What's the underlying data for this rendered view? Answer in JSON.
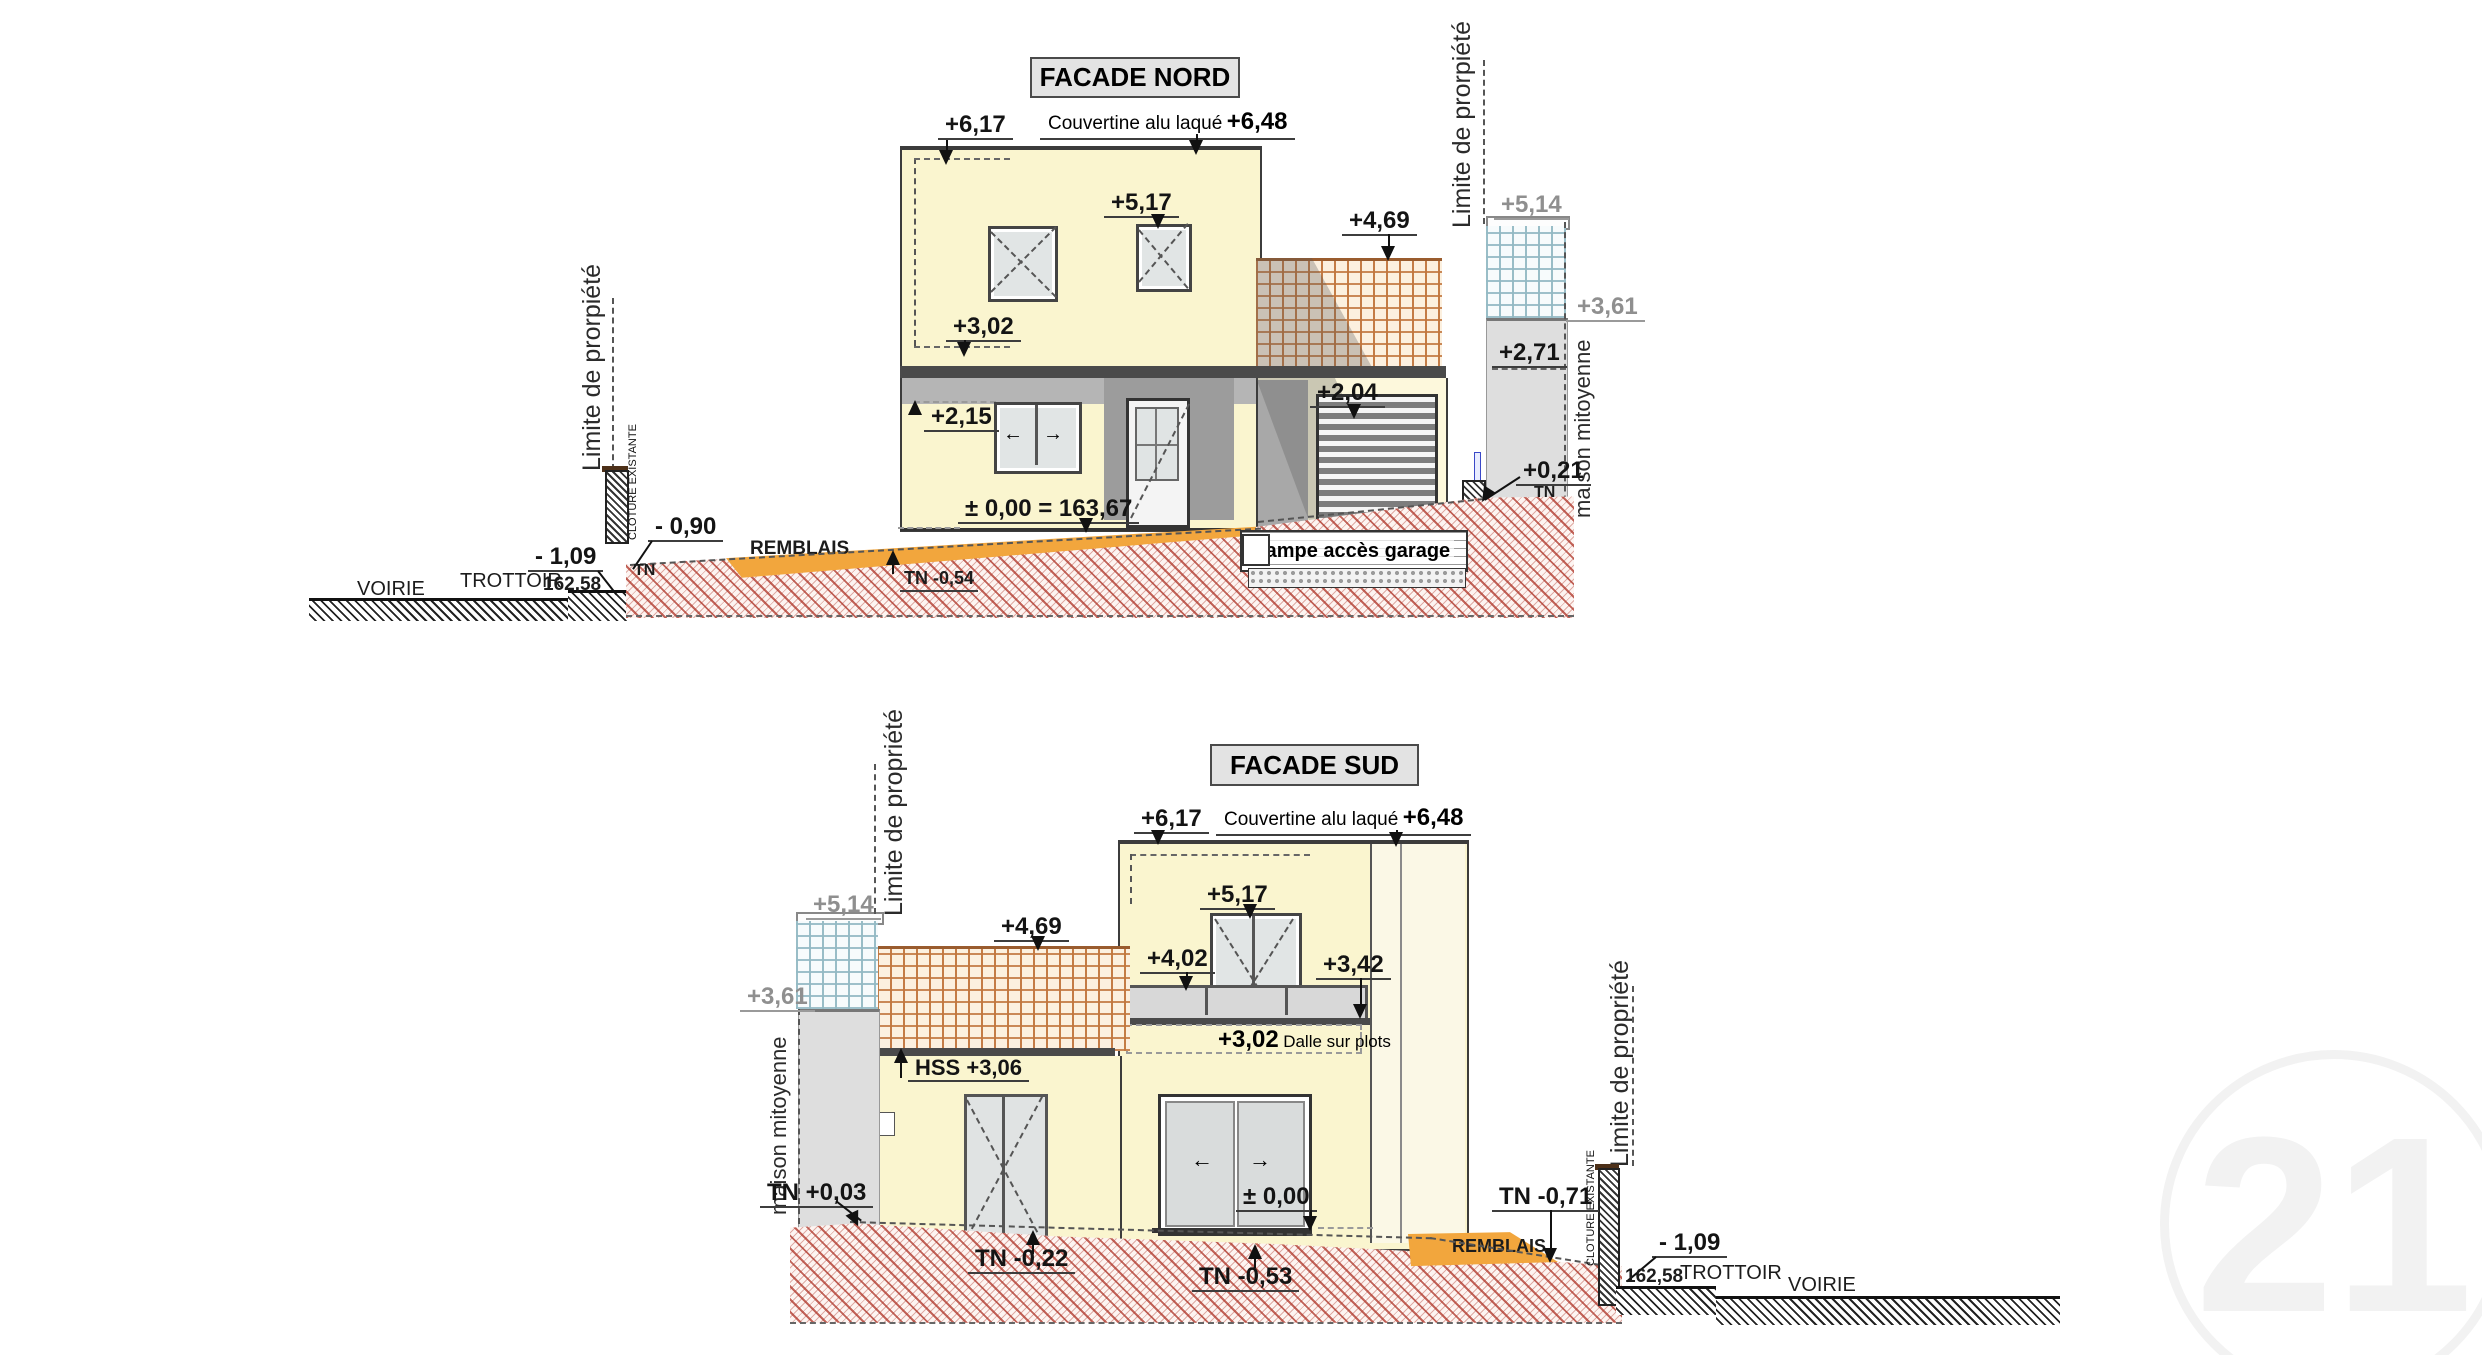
{
  "watermark": "21",
  "nord": {
    "title": "FACADE NORD",
    "limite_left": "Limite de prorpiété",
    "limite_right": "Limite de prorpiété",
    "maison_mitoyenne": "maison mitoyenne",
    "cloture": "CLOTURE EXISTANTE",
    "voirie": "VOIRIE",
    "trottoir": "TROTTOIR",
    "alt": "162,58",
    "remblais": "REMBLAIS",
    "rampe": "rampe accès garage",
    "dims": {
      "d617": "+6,17",
      "couvertine": "Couvertine alu laqué",
      "d648": "+6,48",
      "d517": "+5,17",
      "d469": "+4,69",
      "d514": "+5,14",
      "d361": "+3,61",
      "d302": "+3,02",
      "d271": "+2,71",
      "d215": "+2,15",
      "d204": "+2,04",
      "zero": "± 0,00 = 163,67",
      "d021": "+0,21",
      "tn": "TN",
      "tn2": "TN",
      "d090": "- 0,90",
      "d109": "- 1,09",
      "tn054": "TN -0,54"
    }
  },
  "sud": {
    "title": "FACADE SUD",
    "limite_left": "Limite de propriété",
    "limite_right": "Limite de propriété",
    "maison_mitoyenne": "maison mitoyenne",
    "cloture": "CLOTURE EXISTANTE",
    "voirie": "VOIRIE",
    "trottoir": "TROTTOIR",
    "alt": "162,58",
    "remblais": "REMBLAIS",
    "dims": {
      "d617": "+6,17",
      "couvertine": "Couvertine alu laqué",
      "d648": "+6,48",
      "d517": "+5,17",
      "d469": "+4,69",
      "d514": "+5,14",
      "d361": "+3,61",
      "d402": "+4,02",
      "d342": "+3,42",
      "d302": "+3,02",
      "dalle": "Dalle sur plots",
      "hss": "HSS +3,06",
      "zero": "± 0,00",
      "tn003": "TN +0,03",
      "tn022": "TN -0,22",
      "tn053": "TN -0,53",
      "tn071": "TN -0,71",
      "d109": "- 1,09"
    }
  }
}
